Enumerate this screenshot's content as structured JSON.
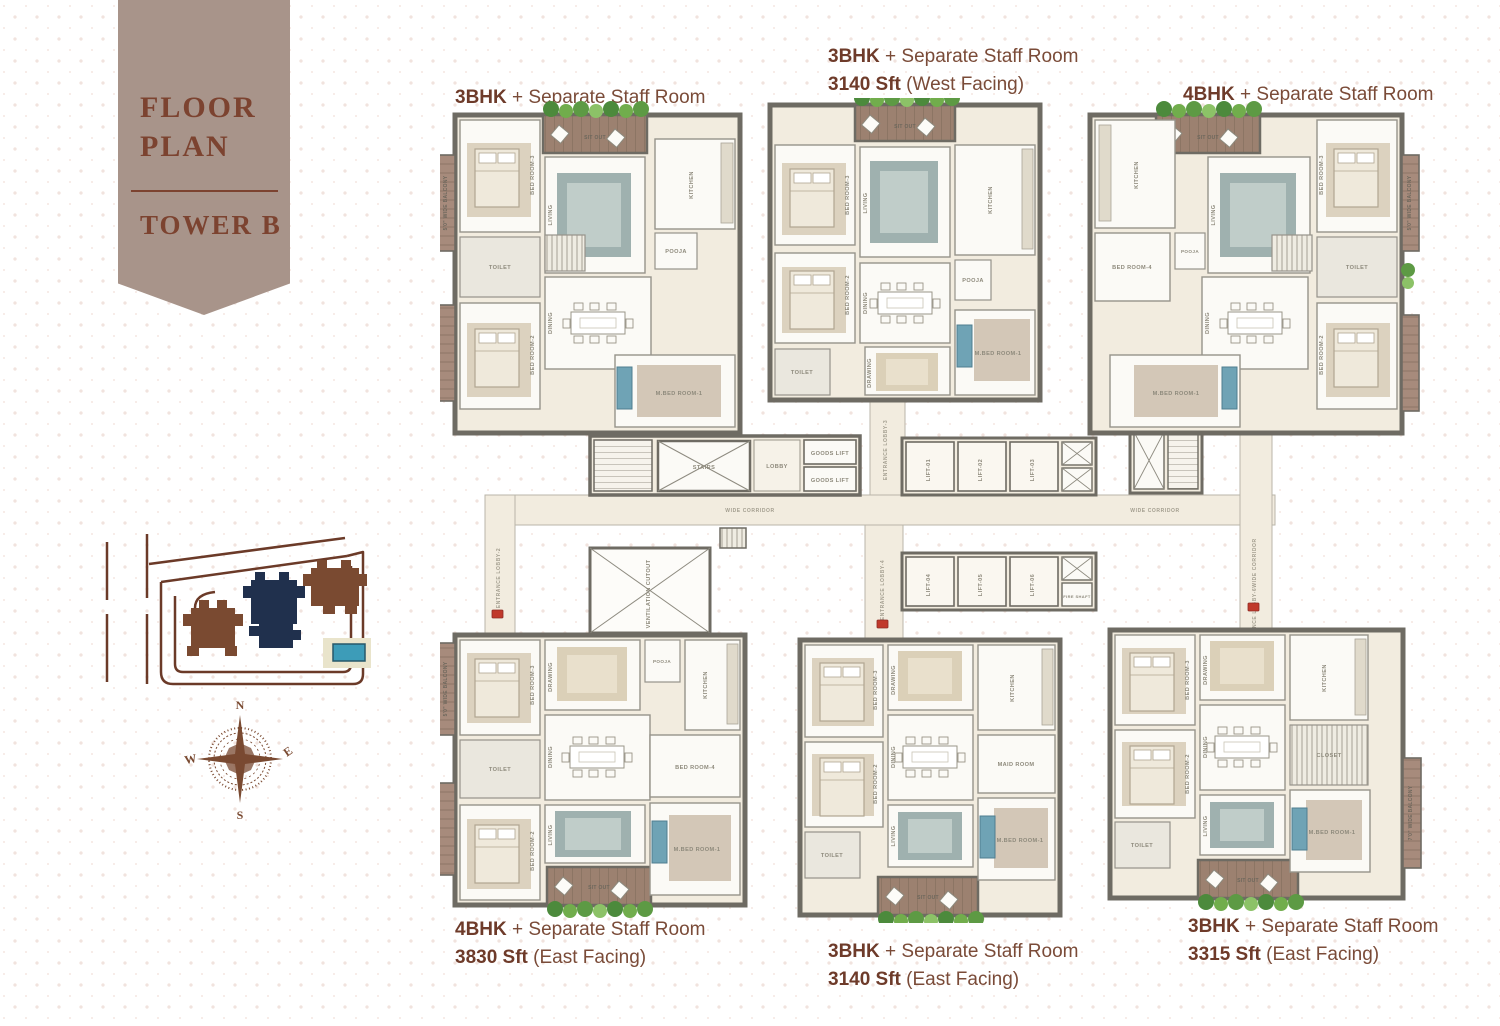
{
  "banner": {
    "line1": "FLOOR",
    "line2": "PLAN",
    "tower": "TOWER B"
  },
  "unit_labels": [
    {
      "pos": "top-left",
      "bhk": "3BHK",
      "plus": "+ Separate Staff Room",
      "area": "3375 Sft",
      "facing": "(West Facing)"
    },
    {
      "pos": "top-center",
      "bhk": "3BHK",
      "plus": "+ Separate Staff Room",
      "area": "3140 Sft",
      "facing": "(West Facing)"
    },
    {
      "pos": "top-right",
      "bhk": "4BHK",
      "plus": "+ Separate Staff Room",
      "area": "3830 Sft",
      "facing": "(West Facing)"
    },
    {
      "pos": "bottom-left",
      "bhk": "4BHK",
      "plus": "+ Separate Staff Room",
      "area": "3830 Sft",
      "facing": "(East Facing)"
    },
    {
      "pos": "bottom-center",
      "bhk": "3BHK",
      "plus": "+ Separate Staff Room",
      "area": "3140 Sft",
      "facing": "(East Facing)"
    },
    {
      "pos": "bottom-right",
      "bhk": "3BHK",
      "plus": "+ Separate Staff Room",
      "area": "3315 Sft",
      "facing": "(East Facing)"
    }
  ],
  "compass": {
    "north": "N",
    "east": "E",
    "south": "S",
    "west": "W"
  },
  "plan": {
    "rooms": {
      "living": "LIVING",
      "dining": "DINING",
      "drawing": "DRAWING",
      "kitchen": "KITCHEN",
      "pooja": "POOJA",
      "bed2": "BED ROOM-2",
      "bed3": "BED ROOM-3",
      "bed4": "BED ROOM-4",
      "mbed": "M.BED ROOM-1",
      "maid": "MAID ROOM",
      "toilet": "TOILET",
      "closet": "CLOSET",
      "sitout": "SIT OUT",
      "balcony5": "5'0\" WIDE BALCONY",
      "balcony7": "7'0\" WIDE BALCONY"
    },
    "core": {
      "lobby": "LOBBY",
      "stairs": "STAIRS",
      "goods_lift": "GOODS LIFT",
      "fire_shaft": "FIRE SHAFT",
      "elec_shaft": "ELEC SHAFT",
      "ventilation": "VENTILATION CUTOUT",
      "corridor": "WIDE CORRIDOR",
      "entrance2": "ENTRANCE LOBBY-2",
      "entrance3": "ENTRANCE LOBBY-3",
      "entrance4": "ENTRANCE LOBBY-4",
      "entrance6": "ENTRANCE LOBBY-6",
      "lifts": [
        "LIFT-01",
        "LIFT-02",
        "LIFT-03",
        "LIFT-04",
        "LIFT-05",
        "LIFT-06"
      ]
    }
  },
  "colors": {
    "banner_bg": "#a8948a",
    "banner_text": "#7c4330",
    "label_text": "#7a4b38",
    "label_bold": "#6e3b2a",
    "wall": "#6e6b63",
    "floor_cream": "#f2ecdf",
    "room_white": "#fbfaf6",
    "deck_wood": "#9c8170",
    "balcony_wood": "#a78b7c",
    "plant_green": "#5d9a44",
    "teal_accent": "#6fa3b5",
    "rug_blue": "#9fb1af",
    "rug_beige": "#dbd0b8",
    "sitemap_highlight_navy": "#20304d",
    "sitemap_building_brown": "#7a4a31",
    "pool_teal": "#3d9cb8",
    "road_brown": "#6b3a28",
    "unit_tag_red": "#c0392b"
  }
}
